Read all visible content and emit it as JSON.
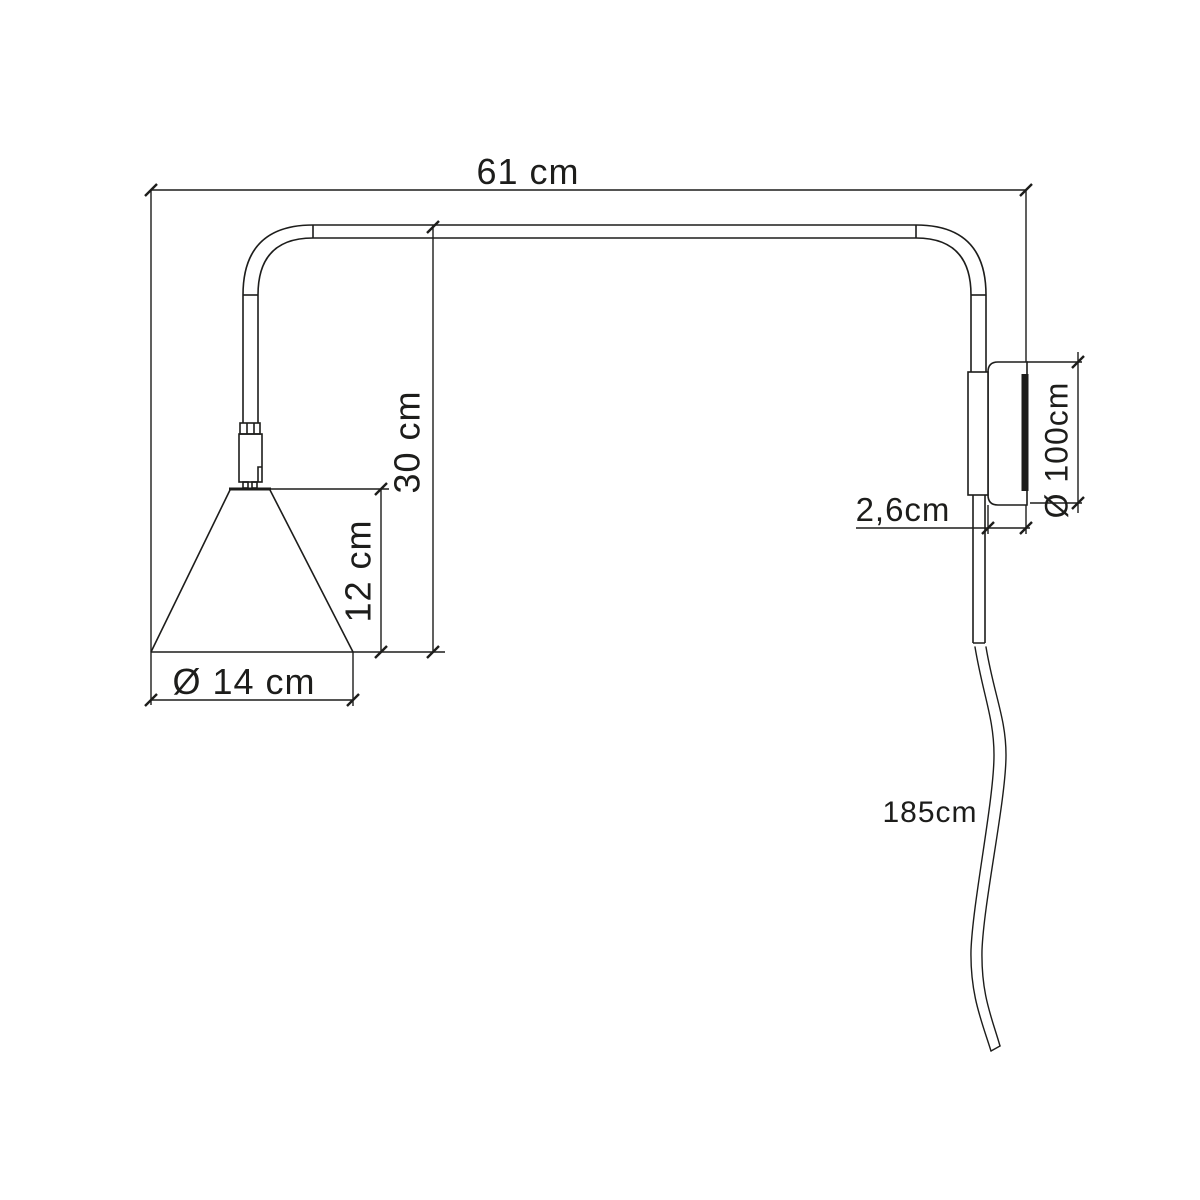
{
  "page": {
    "background_color": "#ffffff",
    "line_color": "#1d1d1b"
  },
  "diagram": {
    "kind": "technical-dimension-drawing",
    "subject": "wall-mounted-arm-lamp-side-view",
    "dimensions": {
      "arm_width": {
        "label": "61 cm"
      },
      "arm_height": {
        "label": "30 cm"
      },
      "shade_height": {
        "label": "12 cm"
      },
      "shade_diameter": {
        "label": "Ø 14 cm"
      },
      "wall_plate_depth": {
        "label": "2,6cm"
      },
      "wall_plate_diameter": {
        "label": "Ø 100cm"
      },
      "cable_length": {
        "label": "185cm"
      }
    }
  }
}
